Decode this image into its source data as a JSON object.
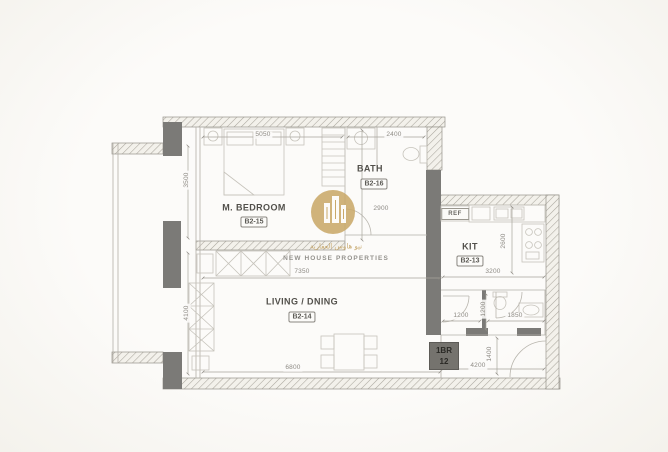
{
  "watermark": {
    "arabic": "نيو هاوس العقارية",
    "company": "NEW HOUSE PROPERTIES"
  },
  "unit_badge": {
    "type": "1BR",
    "number": "12"
  },
  "rooms": {
    "bedroom": {
      "name": "M. BEDROOM",
      "code": "B2-15"
    },
    "bath": {
      "name": "BATH",
      "code": "B2-16"
    },
    "kitchen": {
      "name": "KIT",
      "code": "B2-13"
    },
    "living": {
      "name": "LIVING / DNING",
      "code": "B2-14"
    }
  },
  "fixtures": {
    "ref": "REF"
  },
  "dimensions": {
    "bedroom_width": "5050",
    "bath_width": "2400",
    "bedroom_depth": "3500",
    "living_depth": "4100",
    "bath_corridor_depth": "2900",
    "living_width_upper": "7350",
    "living_width_lower": "6800",
    "kitchen_depth": "2600",
    "kitchen_width": "3200",
    "hall_width": "1200",
    "hall_depth": "1200",
    "wc_width": "1850",
    "entry_depth": "1400",
    "entry_width": "4200"
  },
  "colors": {
    "wall_dark": "#7b7a77",
    "hatch_line": "#aaa69d",
    "thin_line": "#b3b0a8",
    "furniture_line": "#c6c3bb",
    "watermark_gold": "#c9a869"
  }
}
